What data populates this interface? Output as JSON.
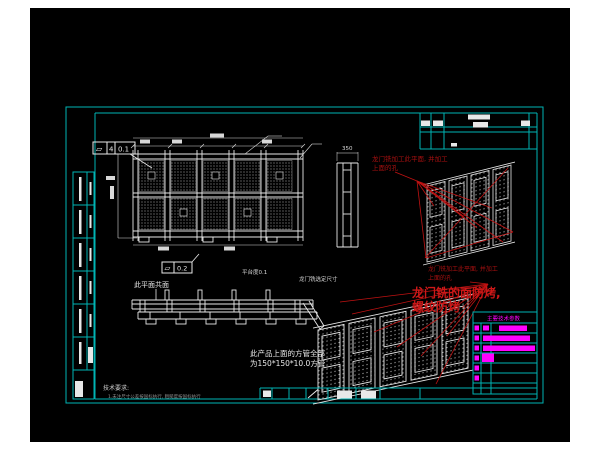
{
  "colors": {
    "page": "#ffffff",
    "canvas": "#000000",
    "frame": "#00b4b4",
    "line": "#e8e8e8",
    "red": "#a81010",
    "red_bright": "#cc1818",
    "magenta": "#ff00ff",
    "grey": "#8f8f8f"
  },
  "feature_controls": {
    "fcf1": {
      "symbol": "▱",
      "datum": "4",
      "value": "0.1"
    },
    "fcf2": {
      "symbol": "▱",
      "value": "0.2"
    }
  },
  "labels": {
    "coplanar": "此平面共面",
    "platform": "平台度0.1",
    "gantry": "龙门铣选定尺寸",
    "dim_side": "350"
  },
  "annotations": {
    "red_note_top": {
      "line1": "龙门铣加工此平面, 并加工",
      "line2": "上面的孔"
    },
    "red_note_mid": {
      "line1": "龙门铣加工此平面, 并加工",
      "line2": "上面的孔"
    },
    "highlight": {
      "line1": "龙门铣的面防烤,",
      "line2": "螺纹防烤"
    }
  },
  "notes": {
    "square_tube": {
      "line1": "此产品上面的方管全部",
      "line2": "为150*150*10.0方管"
    },
    "tech": {
      "title": "技术要求:",
      "line1": "1.未注尺寸公差按国标执行, 粗糙度按国标执行"
    }
  },
  "param_table": {
    "title": "主要技术参数"
  }
}
